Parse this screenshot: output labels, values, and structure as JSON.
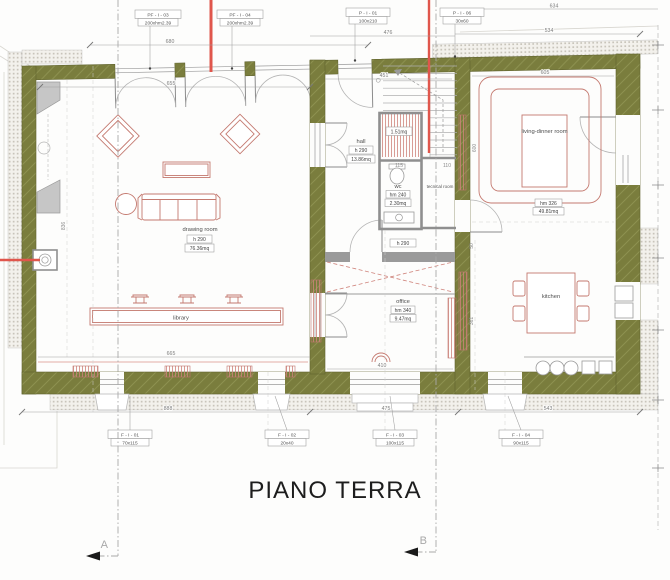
{
  "title": "PIANO TERRA",
  "section_markers": {
    "a": "A",
    "b": "B"
  },
  "colors": {
    "wall_olive": "#7a7d3d",
    "annotation_red": "#e0564c",
    "furniture_red": "#c4796f",
    "partition_gray": "#8f8f8f"
  },
  "window_door_tags": {
    "top": [
      {
        "code": "PF - I - 03",
        "size": "200xhm2.39"
      },
      {
        "code": "PF - I - 04",
        "size": "200xhm2.39"
      },
      {
        "code": "P - I - 01",
        "size": "100x210"
      },
      {
        "code": "P - I - 06",
        "size": "30x60"
      }
    ],
    "bottom": [
      {
        "code": "F - I - 01",
        "size": "70x115"
      },
      {
        "code": "F - I - 02",
        "size": "20x40"
      },
      {
        "code": "F - I - 03",
        "size": "100x115"
      },
      {
        "code": "F - I - 04",
        "size": "90x115"
      }
    ]
  },
  "rooms": {
    "drawing_room": {
      "name": "drawing room",
      "height": "h 290",
      "area": "76.36mq"
    },
    "hall": {
      "name": "hall",
      "height": "h 290",
      "area": "13.86mq"
    },
    "storage": {
      "area": "1.51mq"
    },
    "wc": {
      "name": "wc",
      "height": "hm 240",
      "area": "2.30mq"
    },
    "tecnical": {
      "name": "tecnical room"
    },
    "hall_lower": {
      "height": "h 290"
    },
    "office": {
      "name": "office",
      "height": "hm 340",
      "area": "9.47mq"
    },
    "living": {
      "name": "living-dinner room",
      "height": "hm 326",
      "area": "49.81mq"
    },
    "kitchen": {
      "name": "kitchen"
    },
    "library": {
      "name": "library"
    }
  },
  "dims": {
    "d680": "680",
    "d655": "655",
    "d451": "451",
    "d476": "476",
    "d534": "534",
    "d605": "605",
    "d634": "634",
    "d600": "600",
    "d665": "665",
    "d410": "410",
    "d888": "888",
    "d475": "475",
    "d543": "543",
    "d836": "836",
    "d115": "115",
    "d110": "110",
    "d50": "50",
    "d361": "361"
  }
}
